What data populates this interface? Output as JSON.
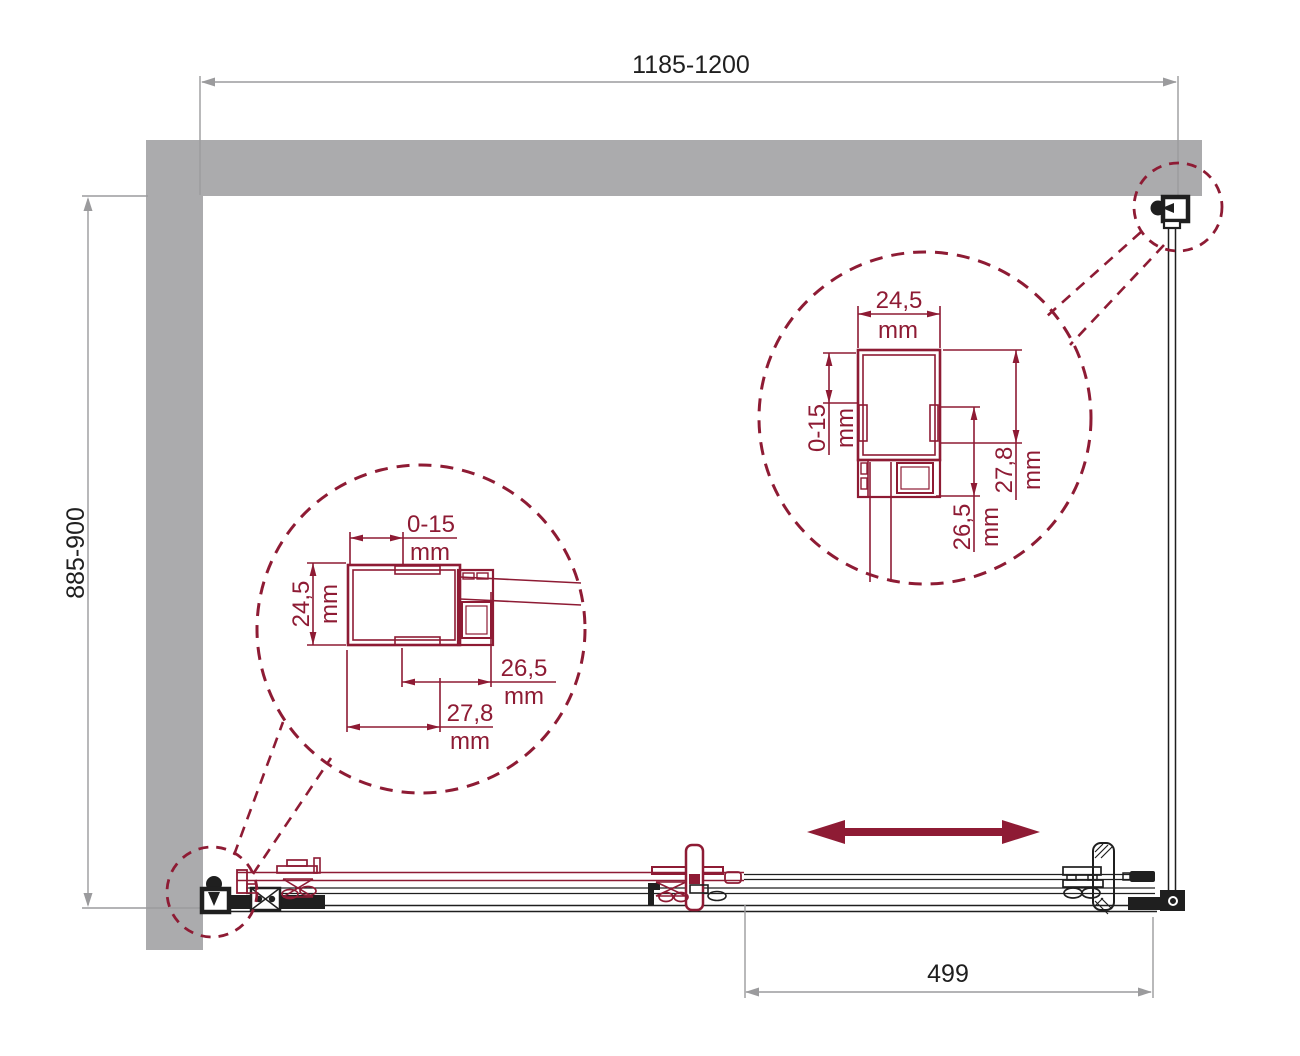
{
  "drawing": {
    "title": "Sliding shower door enclosure — plan view technical drawing",
    "colors": {
      "accent_red": "#8e1b34",
      "wall_gray": "#ababad",
      "dim_gray": "#9b9b9d",
      "line_black": "#1f1f1f"
    }
  },
  "dimensions": {
    "top_width": {
      "value": "1185-1200"
    },
    "left_height": {
      "value": "885-900"
    },
    "bottom_width": {
      "value": "499"
    }
  },
  "detail_left": {
    "dim_top": {
      "value": "0-15",
      "unit": "mm"
    },
    "dim_side": {
      "value": "24,5",
      "unit": "mm"
    },
    "dim_inner": {
      "value": "26,5",
      "unit": "mm"
    },
    "dim_bottom": {
      "value": "27,8",
      "unit": "mm"
    }
  },
  "detail_right": {
    "dim_top": {
      "value": "24,5",
      "unit": "mm"
    },
    "dim_side": {
      "value": "0-15",
      "unit": "mm"
    },
    "dim_inner": {
      "value": "26,5",
      "unit": "mm"
    },
    "dim_right": {
      "value": "27,8",
      "unit": "mm"
    }
  }
}
